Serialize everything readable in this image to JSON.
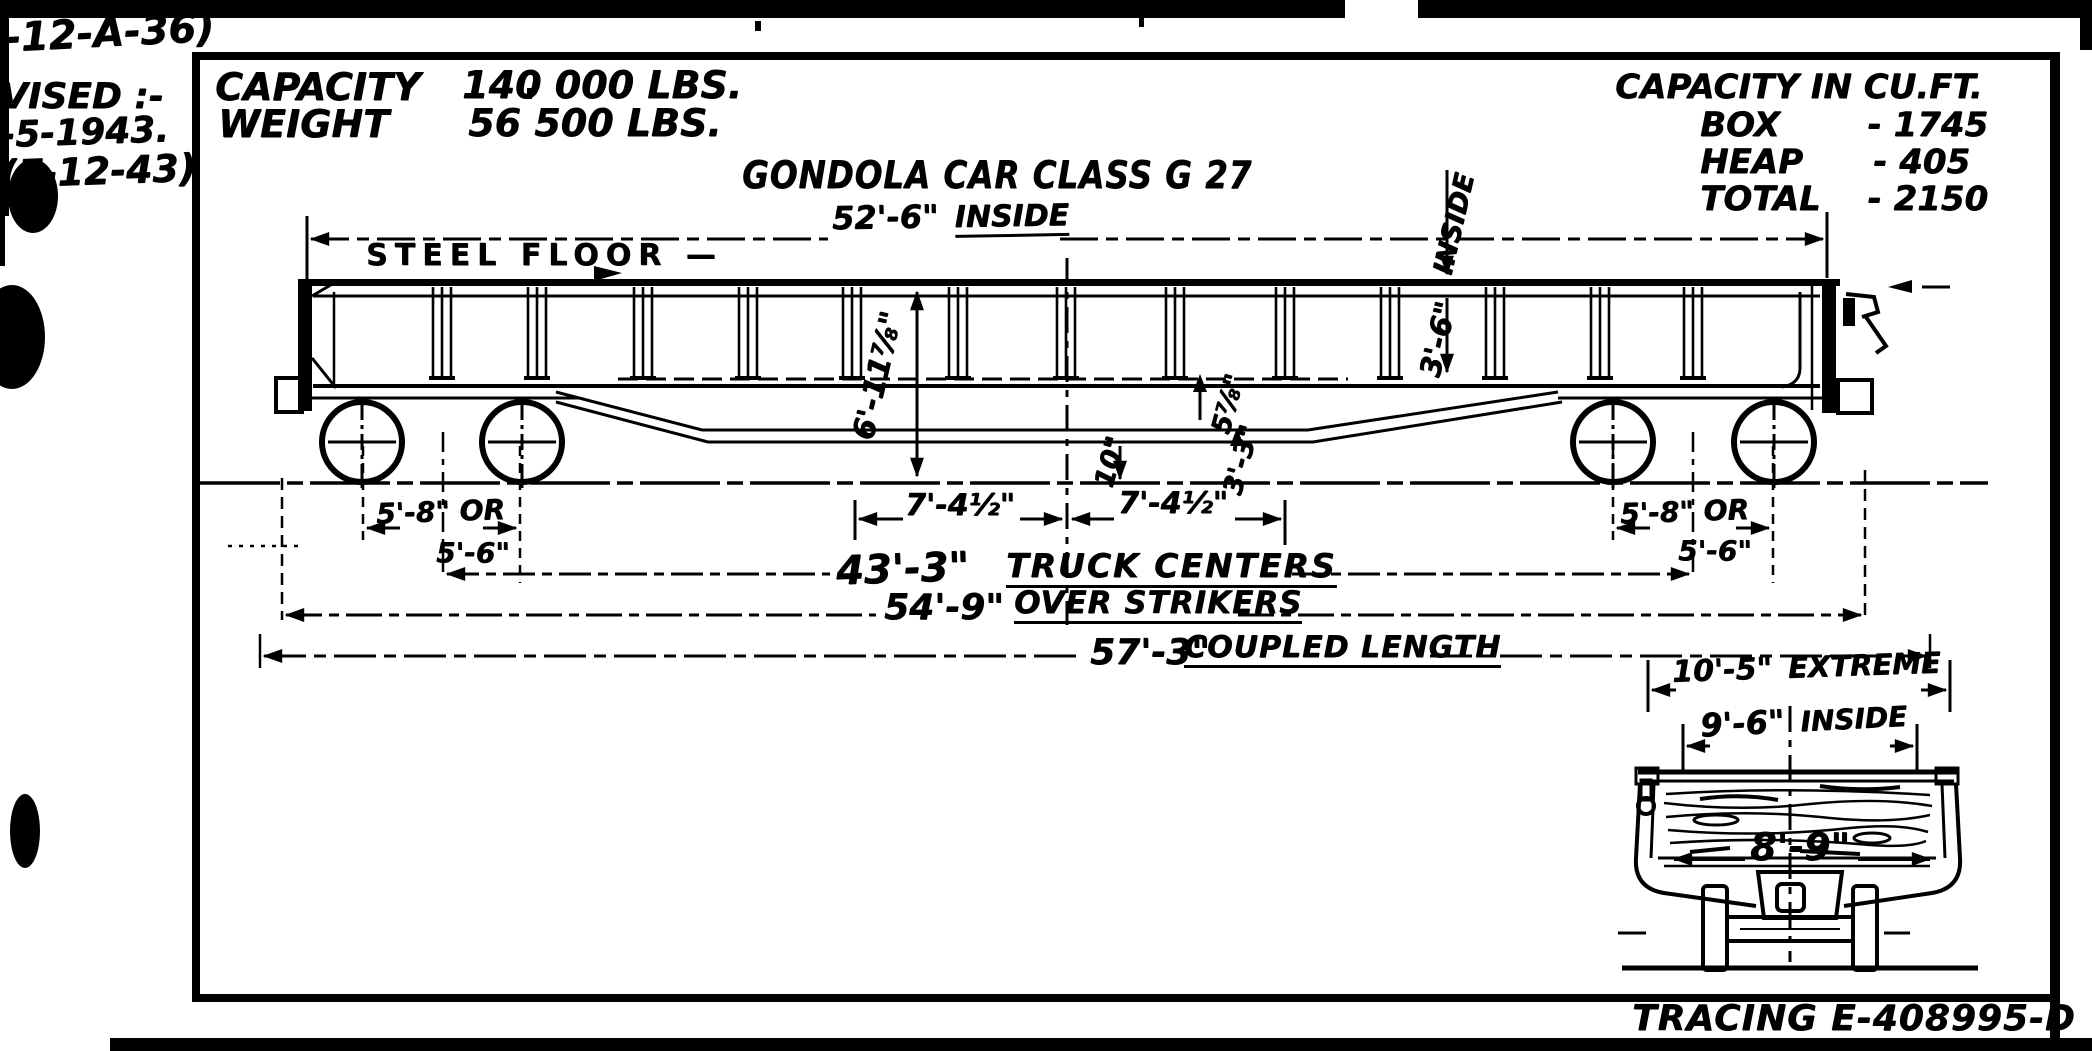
{
  "margin": {
    "note1": "-12-A-36)",
    "note2": "VISED :-",
    "note3": "-5-1943.",
    "note4": "(F-12-43)"
  },
  "header": {
    "capacity_label": "CAPACITY",
    "capacity_value": "140 000 LBS.",
    "weight_label": "WEIGHT",
    "weight_value": "56 500 LBS."
  },
  "cuft": {
    "title": "CAPACITY IN CU.FT.",
    "rows": [
      {
        "label": "BOX",
        "value": "- 1745"
      },
      {
        "label": "HEAP",
        "value": "- 405"
      },
      {
        "label": "TOTAL",
        "value": "- 2150"
      }
    ]
  },
  "title": "GONDOLA CAR CLASS G 27",
  "side_view": {
    "steel_floor": "STEEL FLOOR —",
    "inside_length": "52'-6\"",
    "inside_length_word": "INSIDE",
    "height_over_rail": "6'-11⅞\"",
    "inside_height_word": "INSIDE",
    "inside_height": "3'-6\"",
    "dim_5_78": "5⅞\"",
    "dim_10": "10\"",
    "dim_3_3": "3'-3\"",
    "bolster_left": "7'-4½\"",
    "bolster_right": "7'-4½\"",
    "truck_left_a": "5'-8\" OR",
    "truck_left_b": "5'-6\"",
    "truck_right_a": "5'-8\" OR",
    "truck_right_b": "5'-6\"",
    "truck_centers": "43'-3\"",
    "truck_centers_word": "TRUCK CENTERS",
    "over_strikers": "54'-9\"",
    "over_strikers_word": "OVER STRIKERS",
    "coupled": "57'-3\"",
    "coupled_word": "COUPLED LENGTH"
  },
  "end_view": {
    "extreme": "10'-5\"",
    "extreme_word": "EXTREME",
    "inside": "9'-6\"",
    "inside_word": "INSIDE",
    "floor_width": "8'-9\""
  },
  "footer": {
    "tracing": "TRACING E-408995-D"
  }
}
